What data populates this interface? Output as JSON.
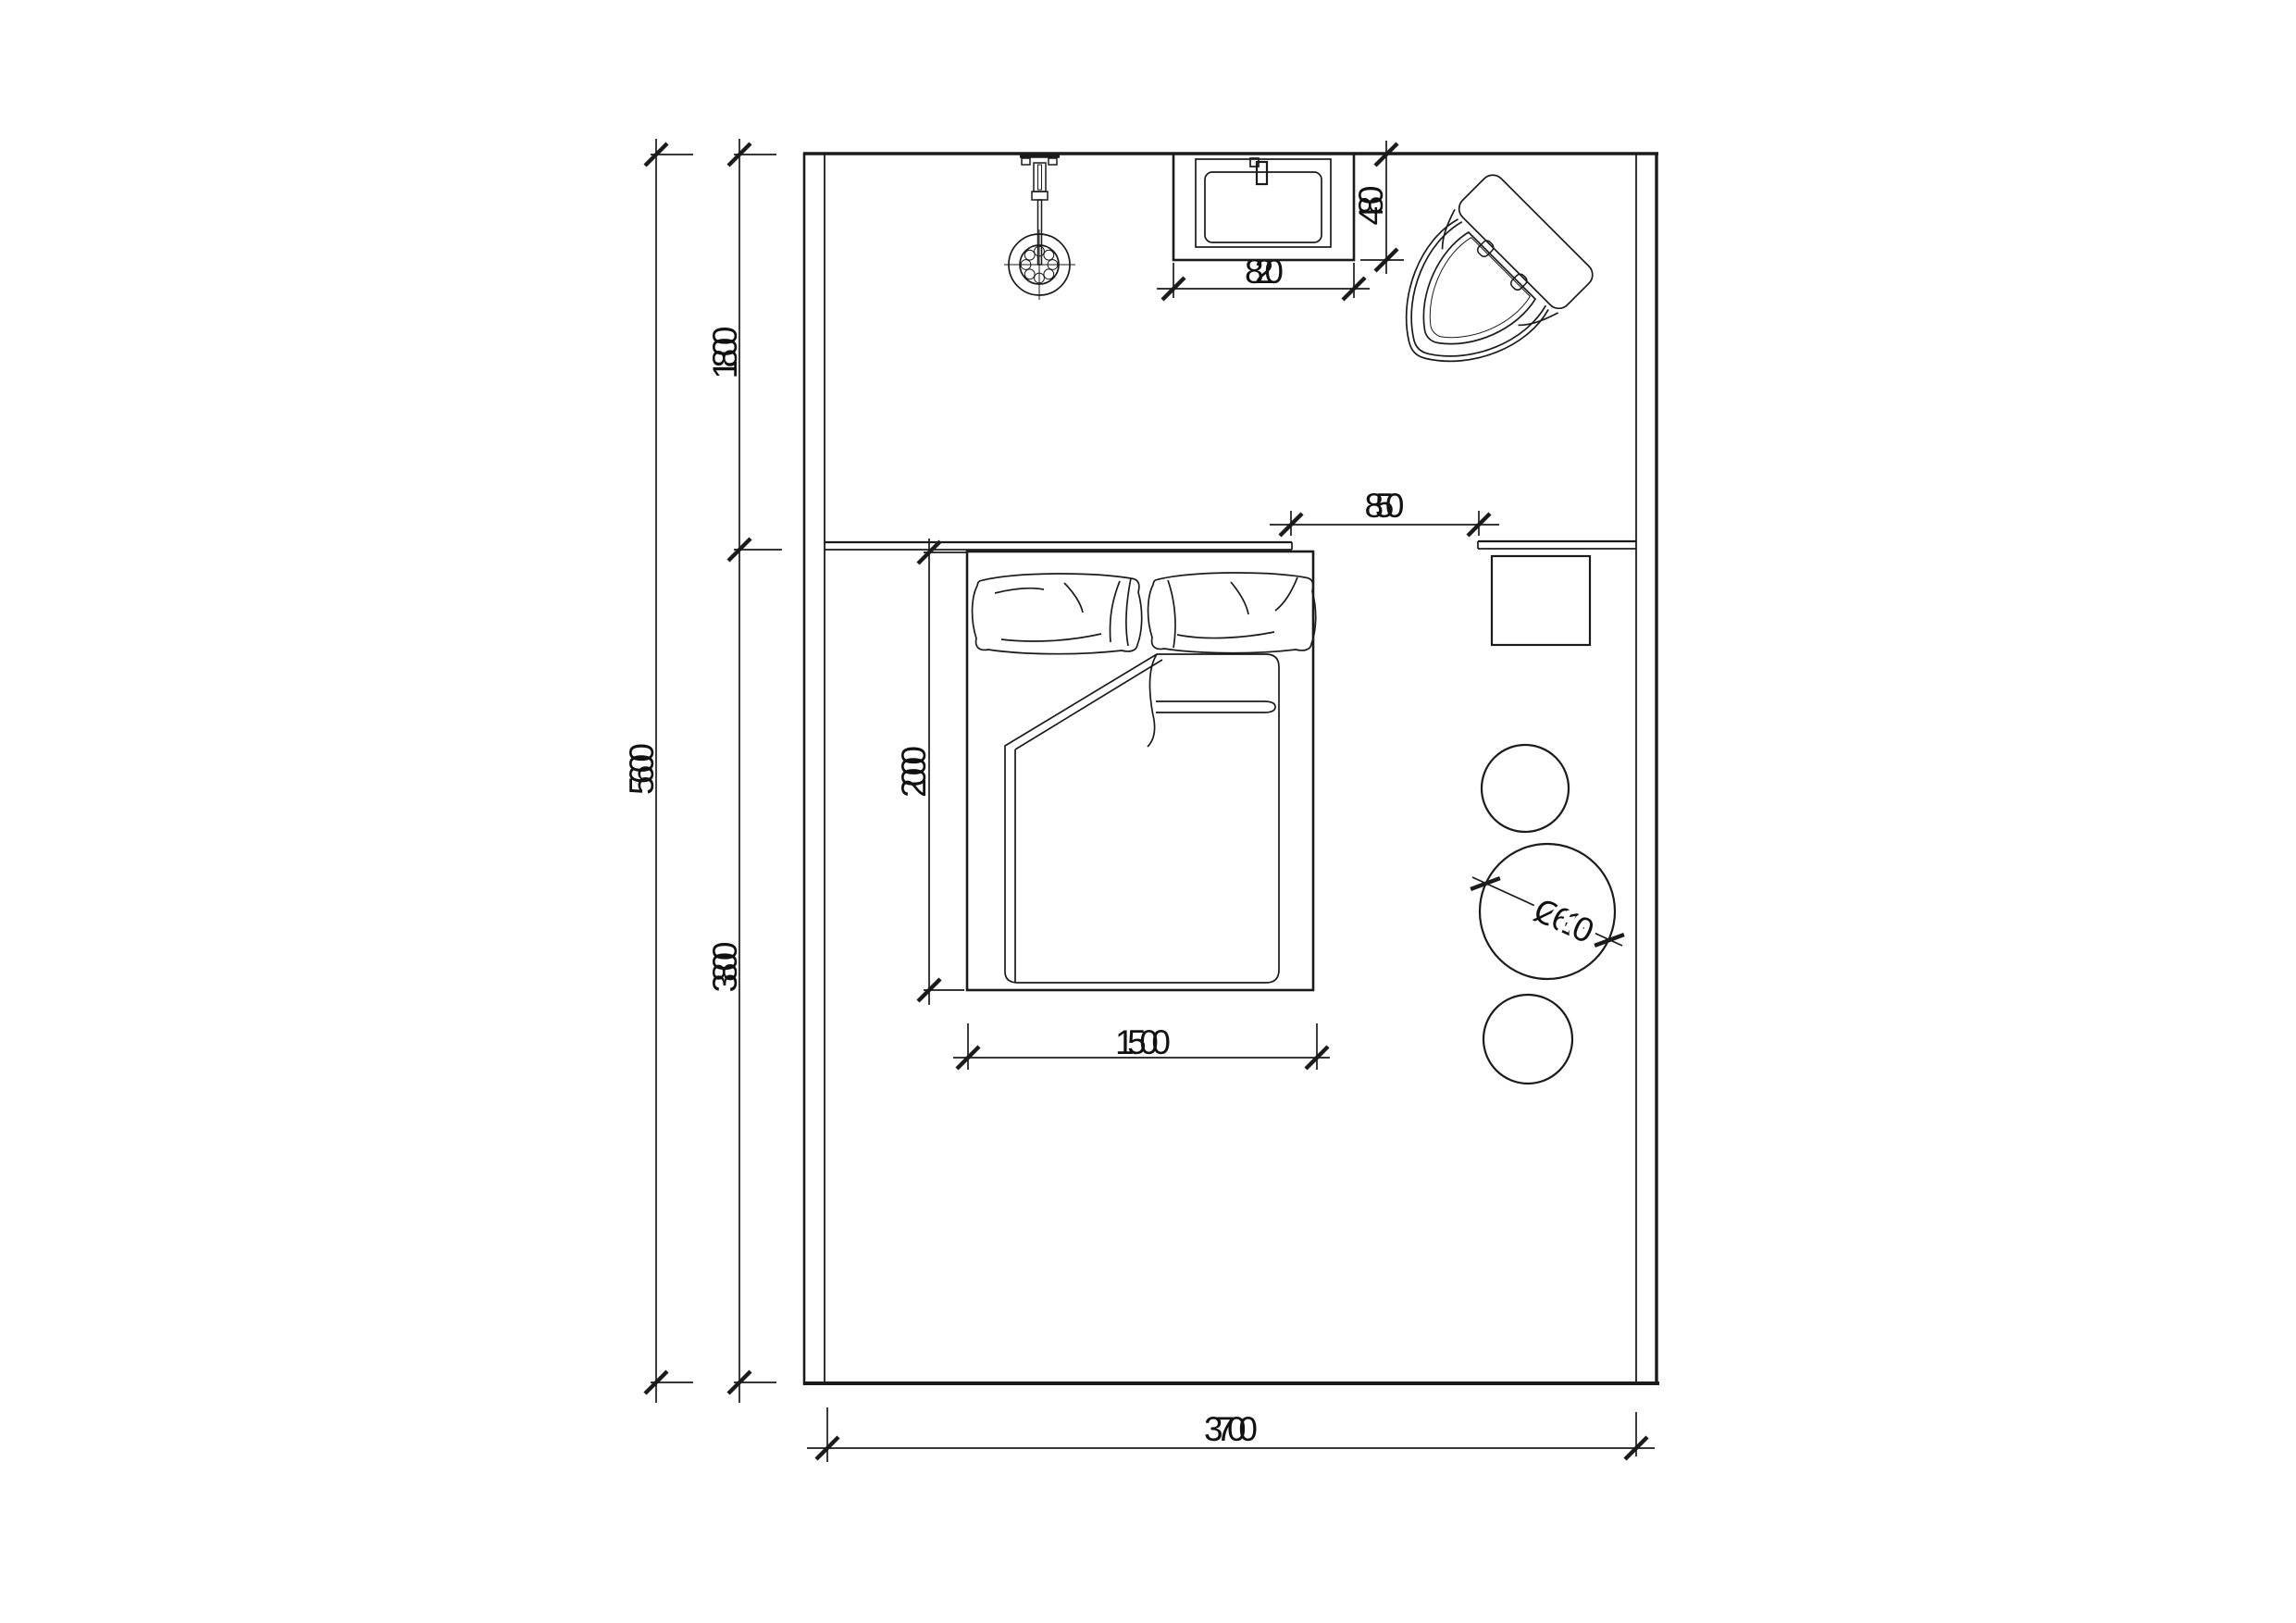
{
  "drawing": {
    "title": "bedroom-floor-plan",
    "colors": {
      "background": "#ffffff",
      "line": "#1b1b1b",
      "text": "#111111"
    },
    "dimensions": {
      "overall_depth": "5600",
      "bath_zone_depth": "1800",
      "bedroom_zone_depth": "3800",
      "bed_length": "2000",
      "bed_width": "1500",
      "room_width": "3700",
      "bed_to_table_gap": "850",
      "basin_width": "820",
      "basin_depth": "480",
      "table_diameter": "Ø610"
    },
    "fixtures": {
      "shower": "shower-head",
      "basin": "washbasin",
      "toilet": "toilet",
      "bed": "double-bed",
      "headboard": "headboard-ledge",
      "counter": "side-counter",
      "side_table": "side-table",
      "stools": "round-stools"
    }
  }
}
